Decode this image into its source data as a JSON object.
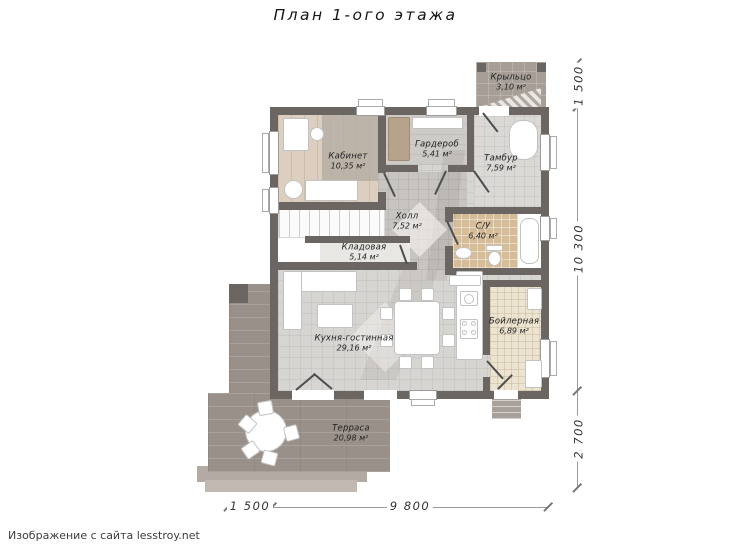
{
  "title": "План 1-ого этажа",
  "watermark": "Изображение с сайта lesstroy.net",
  "rooms": {
    "office": {
      "name": "Кабинет",
      "area": "10,35 м²"
    },
    "wardrobe": {
      "name": "Гардероб",
      "area": "5,41 м²"
    },
    "vestibule": {
      "name": "Тамбур",
      "area": "7,59 м²"
    },
    "hall": {
      "name": "Холл",
      "area": "7,52 м²"
    },
    "bathroom": {
      "name": "С/У",
      "area": "6,40 м²"
    },
    "storage": {
      "name": "Кладовая",
      "area": "5,14 м²"
    },
    "kitchen_living": {
      "name": "Кухня-гостинная",
      "area": "29,16 м²"
    },
    "boiler": {
      "name": "Бойлерная",
      "area": "6,89 м²"
    },
    "terrace": {
      "name": "Терраса",
      "area": "20,98 м²"
    },
    "porch": {
      "name": "Крыльцо",
      "area": "3,10 м²"
    }
  },
  "dims": {
    "right_top": "1 500",
    "right_middle": "10 300",
    "right_bottom": "2 700",
    "bottom_left": "1 500",
    "bottom_right": "9 800"
  },
  "colors": {
    "wall": "#6b6661",
    "floor": "#d7d5d2",
    "hall": "#c8c5c1",
    "wood": "#dccfbf",
    "rug": "#b3aba2",
    "tan": "#d6bc97",
    "cream": "#ece3d0",
    "terr": "#99908a",
    "porch": "#a69e97",
    "furnb": "#c2c2c2"
  }
}
